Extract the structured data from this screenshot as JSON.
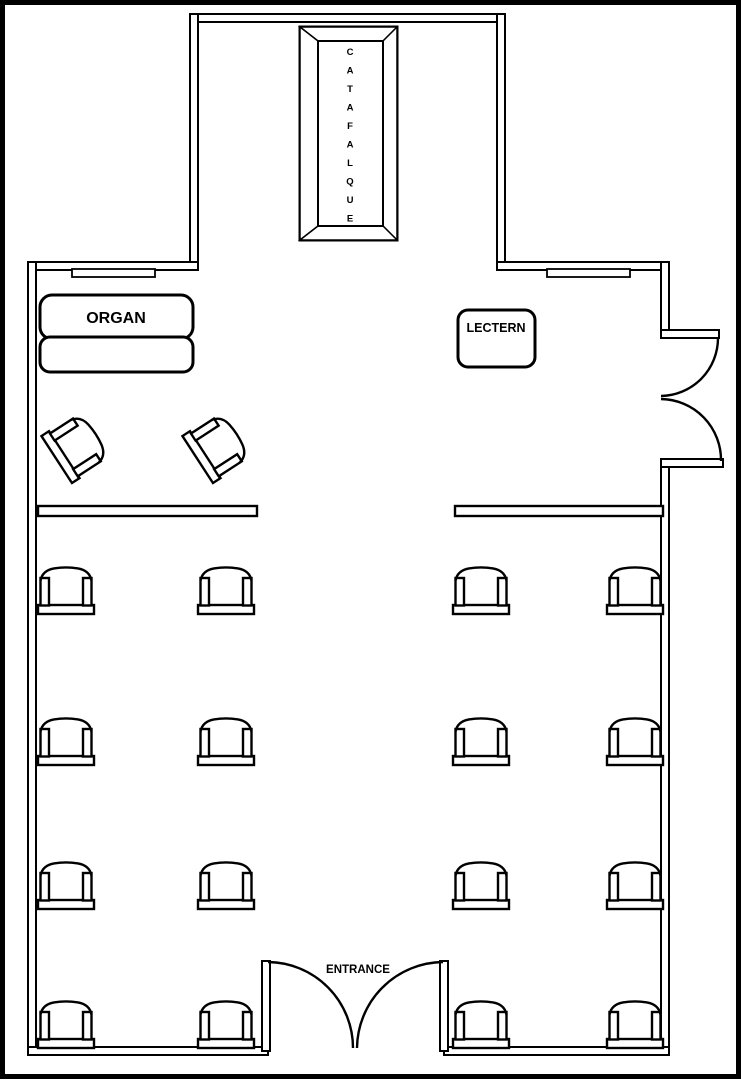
{
  "title": "Chapel floor plan",
  "colors": {
    "line": "#000000",
    "background": "#ffffff",
    "catafalque_bevel_dark": "#4d4d4d",
    "catafalque_bevel_light": "#a6a6a6"
  },
  "catafalque": {
    "label": "CATAFALQUE",
    "letters": [
      "C",
      "A",
      "T",
      "A",
      "F",
      "A",
      "L",
      "Q",
      "U",
      "E"
    ]
  },
  "organ": {
    "label": "ORGAN"
  },
  "lectern": {
    "label": "LECTERN"
  },
  "entrance": {
    "label": "ENTRANCE"
  },
  "furniture": {
    "pew_chairs": 16,
    "pew_rows": 4,
    "pew_columns": 4,
    "celebrant_chairs": 2,
    "rails": 2,
    "side_door_leaves": 2,
    "entrance_door_leaves": 2
  }
}
